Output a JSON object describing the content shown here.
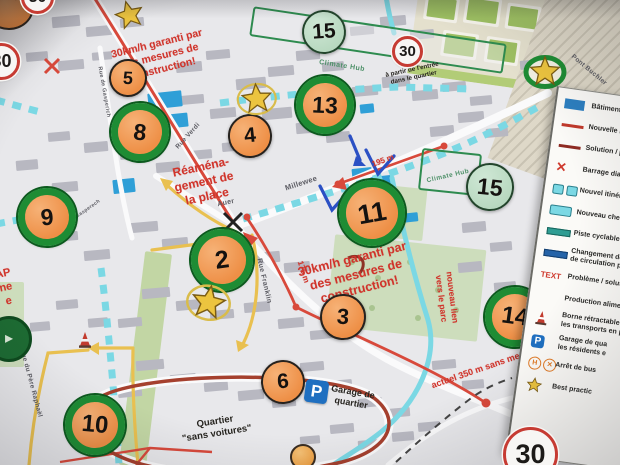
{
  "stickers": [
    {
      "label": "2",
      "style": "green-ring"
    },
    {
      "label": "3",
      "style": "plain"
    },
    {
      "label": "4",
      "style": "plain"
    },
    {
      "label": "5",
      "style": "plain"
    },
    {
      "label": "6",
      "style": "plain"
    },
    {
      "label": "8",
      "style": "green-ring"
    },
    {
      "label": "9",
      "style": "green-ring"
    },
    {
      "label": "10",
      "style": "green-ring"
    },
    {
      "label": "11",
      "style": "green-ring"
    },
    {
      "label": "13",
      "style": "green-ring"
    },
    {
      "label": "14",
      "style": "green-ring"
    },
    {
      "label": "15",
      "style": "mint"
    },
    {
      "label": "15",
      "style": "mint"
    }
  ],
  "star_stickers": [
    {
      "style": "plain"
    },
    {
      "style": "yellow-ring"
    },
    {
      "style": "yellow-ring"
    },
    {
      "style": "green-ring"
    }
  ],
  "speed_signs": [
    {
      "label": "30"
    },
    {
      "label": "30"
    },
    {
      "label": "30"
    },
    {
      "label": "30"
    }
  ],
  "notes_red": [
    {
      "lines": [
        "30km/h garanti par",
        "des mesures de",
        "construction!"
      ]
    },
    {
      "lines": [
        "Réaména-",
        "gement de",
        "la place"
      ]
    },
    {
      "lines": [
        "30km/h garanti par",
        "des mesures de",
        "construction!"
      ]
    },
    {
      "lines": [
        "195 m"
      ]
    },
    {
      "lines": [
        "175 m"
      ]
    },
    {
      "lines": [
        "actuel 350 m sans mesures"
      ]
    },
    {
      "lines": [
        "nouveau lien",
        "vers le parc"
      ]
    },
    {
      "lines": [
        "AP",
        "ne",
        "e"
      ]
    }
  ],
  "notes_black": [
    {
      "lines": [
        "à partir de l'entrée",
        "dans le quartier"
      ]
    },
    {
      "lines": [
        "Garage de",
        "quartier"
      ]
    },
    {
      "lines": [
        "Quartier",
        "\"sans voitures\""
      ]
    }
  ],
  "street_names": [
    {
      "text": "Rue de Gasperich"
    },
    {
      "text": "Rue Verdi"
    },
    {
      "text": "Auer"
    },
    {
      "text": "Millewee"
    },
    {
      "text": "Rue Franklin"
    },
    {
      "text": "Rue du Père Raphaël"
    },
    {
      "text": "Gasperech"
    },
    {
      "text": "Pont Buchler"
    }
  ],
  "area_labels": [
    {
      "text": "Climate Hub"
    },
    {
      "text": "Climate Hub"
    }
  ],
  "map_icons": [
    {
      "name": "parking-icon",
      "glyph": "P"
    },
    {
      "name": "traffic-cone-icon"
    },
    {
      "name": "barrier-x-icon"
    }
  ],
  "legend": {
    "text_sample": "TEXT",
    "items": [
      {
        "icon": "building",
        "lines": [
          "Bâtiments pub"
        ]
      },
      {
        "icon": "line-red",
        "lines": [
          "Nouvelle rue"
        ]
      },
      {
        "icon": "line-darkred",
        "lines": [
          "Solution / pro"
        ]
      },
      {
        "icon": "x-red",
        "lines": [
          "Barrage diago"
        ]
      },
      {
        "icon": "cyan-dash",
        "lines": [
          "Nouvel itinérair"
        ]
      },
      {
        "icon": "cyan-solid",
        "lines": [
          "Nouveau chemi"
        ]
      },
      {
        "icon": "teal-bar",
        "lines": [
          "Piste cyclable pr"
        ]
      },
      {
        "icon": "blue-bar",
        "lines": [
          "Changement de s",
          "de circulation pré"
        ]
      },
      {
        "icon": "text-sample",
        "lines": [
          "Problème / solutio"
        ]
      },
      {
        "icon": "none",
        "lines": [
          "Production alimen"
        ]
      },
      {
        "icon": "cone",
        "lines": [
          "Borne rétractable po",
          "les transports en pu"
        ]
      },
      {
        "icon": "parking",
        "lines": [
          "Garage de qua",
          "les résidents e"
        ]
      },
      {
        "icon": "bus",
        "lines": [
          "Arrêt de bus"
        ]
      },
      {
        "icon": "star",
        "lines": [
          "Best practic"
        ]
      }
    ]
  },
  "colors": {
    "sticker_orange": "#ee8f46",
    "ring_green": "#1e8c34",
    "mint": "#b7d8bf",
    "note_red": "#d0342b",
    "route_red": "#d8493b",
    "route_cyan": "#7bd8e4",
    "route_yellow": "#e9c050",
    "loop_red": "#a5402e",
    "building_blue": "#2f9fd7",
    "park_green": "#cdddbc",
    "court_green": "#9dbf62",
    "arrow_blue": "#2b50c4"
  }
}
